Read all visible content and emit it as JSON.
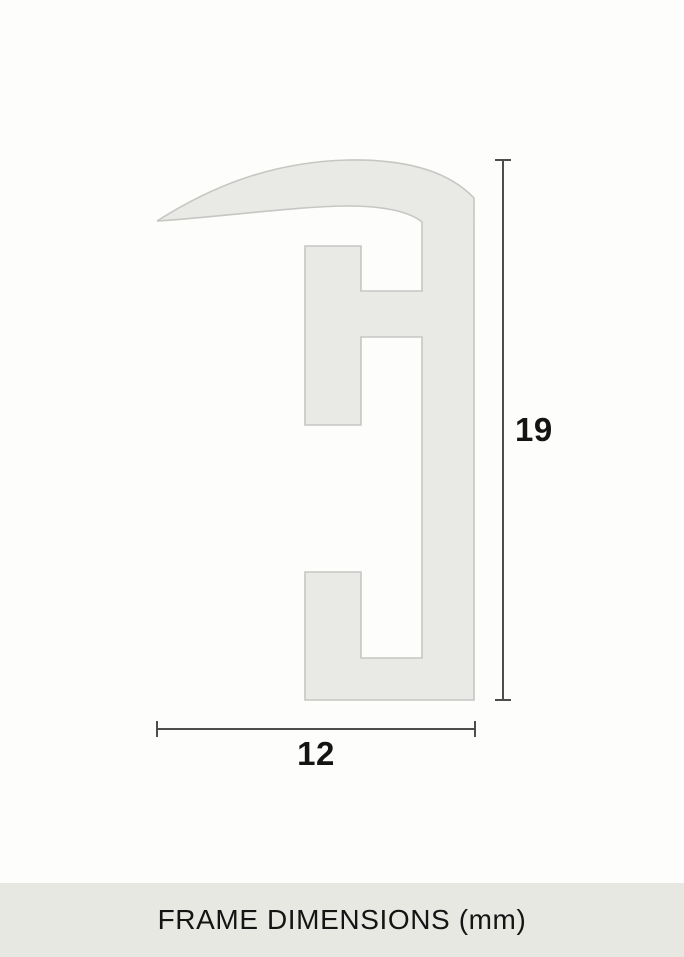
{
  "diagram": {
    "shape": "frame-profile-cross-section",
    "height_label": "19",
    "width_label": "12",
    "unit": "mm"
  },
  "footer": {
    "caption": "FRAME DIMENSIONS (mm)"
  },
  "colors": {
    "background": "#fdfdfc",
    "profile_fill": "#e9e9e6",
    "profile_stroke": "#c6c6c3",
    "dimension_line": "#4d4d4d",
    "label_text": "#141414",
    "footer_bg": "#e8e8e3"
  }
}
